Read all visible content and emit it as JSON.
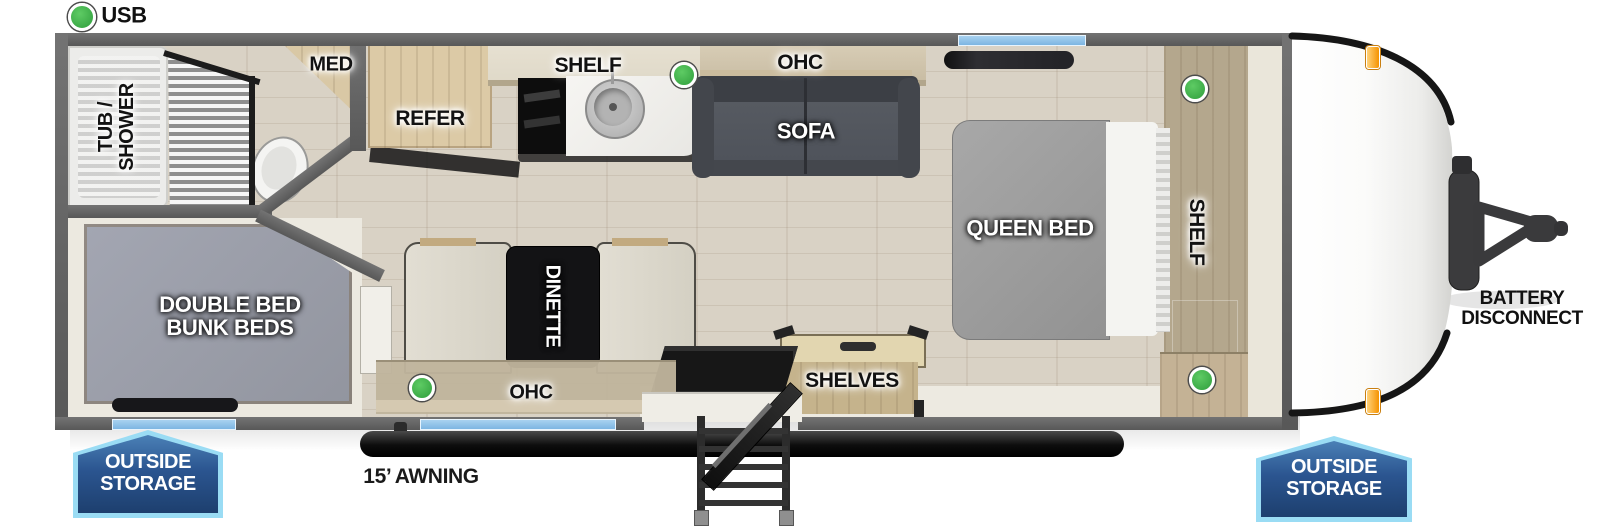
{
  "legend": {
    "usb": "USB"
  },
  "bathroom": {
    "tub_line1": "TUB /",
    "tub_line2": "SHOWER",
    "med": "MED"
  },
  "kitchen": {
    "refer": "REFER",
    "shelf": "SHELF",
    "ohc": "OHC"
  },
  "living": {
    "sofa": "SOFA",
    "dinette": "DINETTE",
    "dinette_ohc": "OHC",
    "shelves": "SHELVES"
  },
  "bedroom": {
    "queen_bed": "QUEEN BED",
    "shelf": "SHELF"
  },
  "bunkroom": {
    "line1": "DOUBLE BED",
    "line2": "BUNK BEDS"
  },
  "exterior": {
    "awning": "15’ AWNING",
    "battery_line1": "BATTERY",
    "battery_line2": "DISCONNECT",
    "storage_rear_line1": "OUTSIDE",
    "storage_rear_line2": "STORAGE",
    "storage_front_line1": "OUTSIDE",
    "storage_front_line2": "STORAGE"
  },
  "colors": {
    "usb_green": "#3cae47",
    "window_blue": "#8ec4ea",
    "wall_gray": "#5f5f5f",
    "wood_tan": "#cdbb94",
    "badge_blue_dark": "#1d3f6e",
    "badge_blue_light": "#447bb0",
    "badge_border": "#9adcf4",
    "marker_orange": "#f59e1f"
  }
}
